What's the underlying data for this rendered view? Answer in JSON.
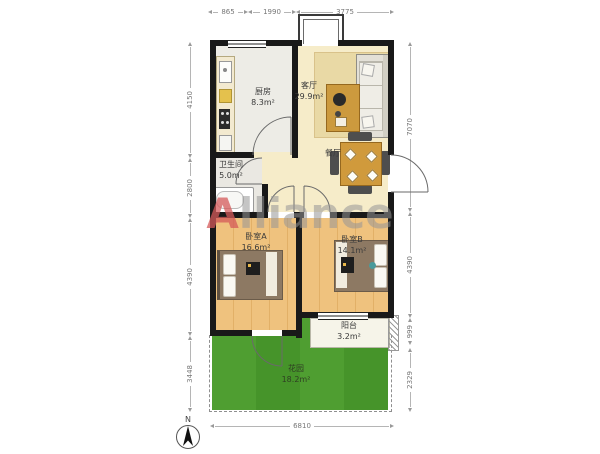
{
  "watermark": {
    "first_letter": "A",
    "rest": "lliance"
  },
  "compass": {
    "label": "N"
  },
  "dims": {
    "top": [
      "865",
      "1990",
      "3775"
    ],
    "left": [
      "4150",
      "2800",
      "4390",
      "3448"
    ],
    "right": [
      "7070",
      "4390",
      "999",
      "2329"
    ],
    "bottom": [
      "6810"
    ]
  },
  "rooms": {
    "kitchen": {
      "name": "厨房",
      "area": "8.3m²"
    },
    "living": {
      "name": "客厅",
      "area": "29.9m²"
    },
    "bathroom": {
      "name": "卫生间",
      "area": "5.0m²"
    },
    "dining": {
      "name": "餐厅",
      "area": ""
    },
    "bedroomA": {
      "name": "卧室A",
      "area": "16.6m²"
    },
    "bedroomB": {
      "name": "卧室B",
      "area": "14.1m²"
    },
    "balcony": {
      "name": "阳台",
      "area": "3.2m²"
    },
    "garden": {
      "name": "花园",
      "area": "18.2m²"
    }
  },
  "colors": {
    "wall": "#191919",
    "living_floor": "#f6ecc9",
    "wood_floor": "#efc27e",
    "grass": "#4f9e31",
    "watermark_red": "#d45a5a"
  }
}
